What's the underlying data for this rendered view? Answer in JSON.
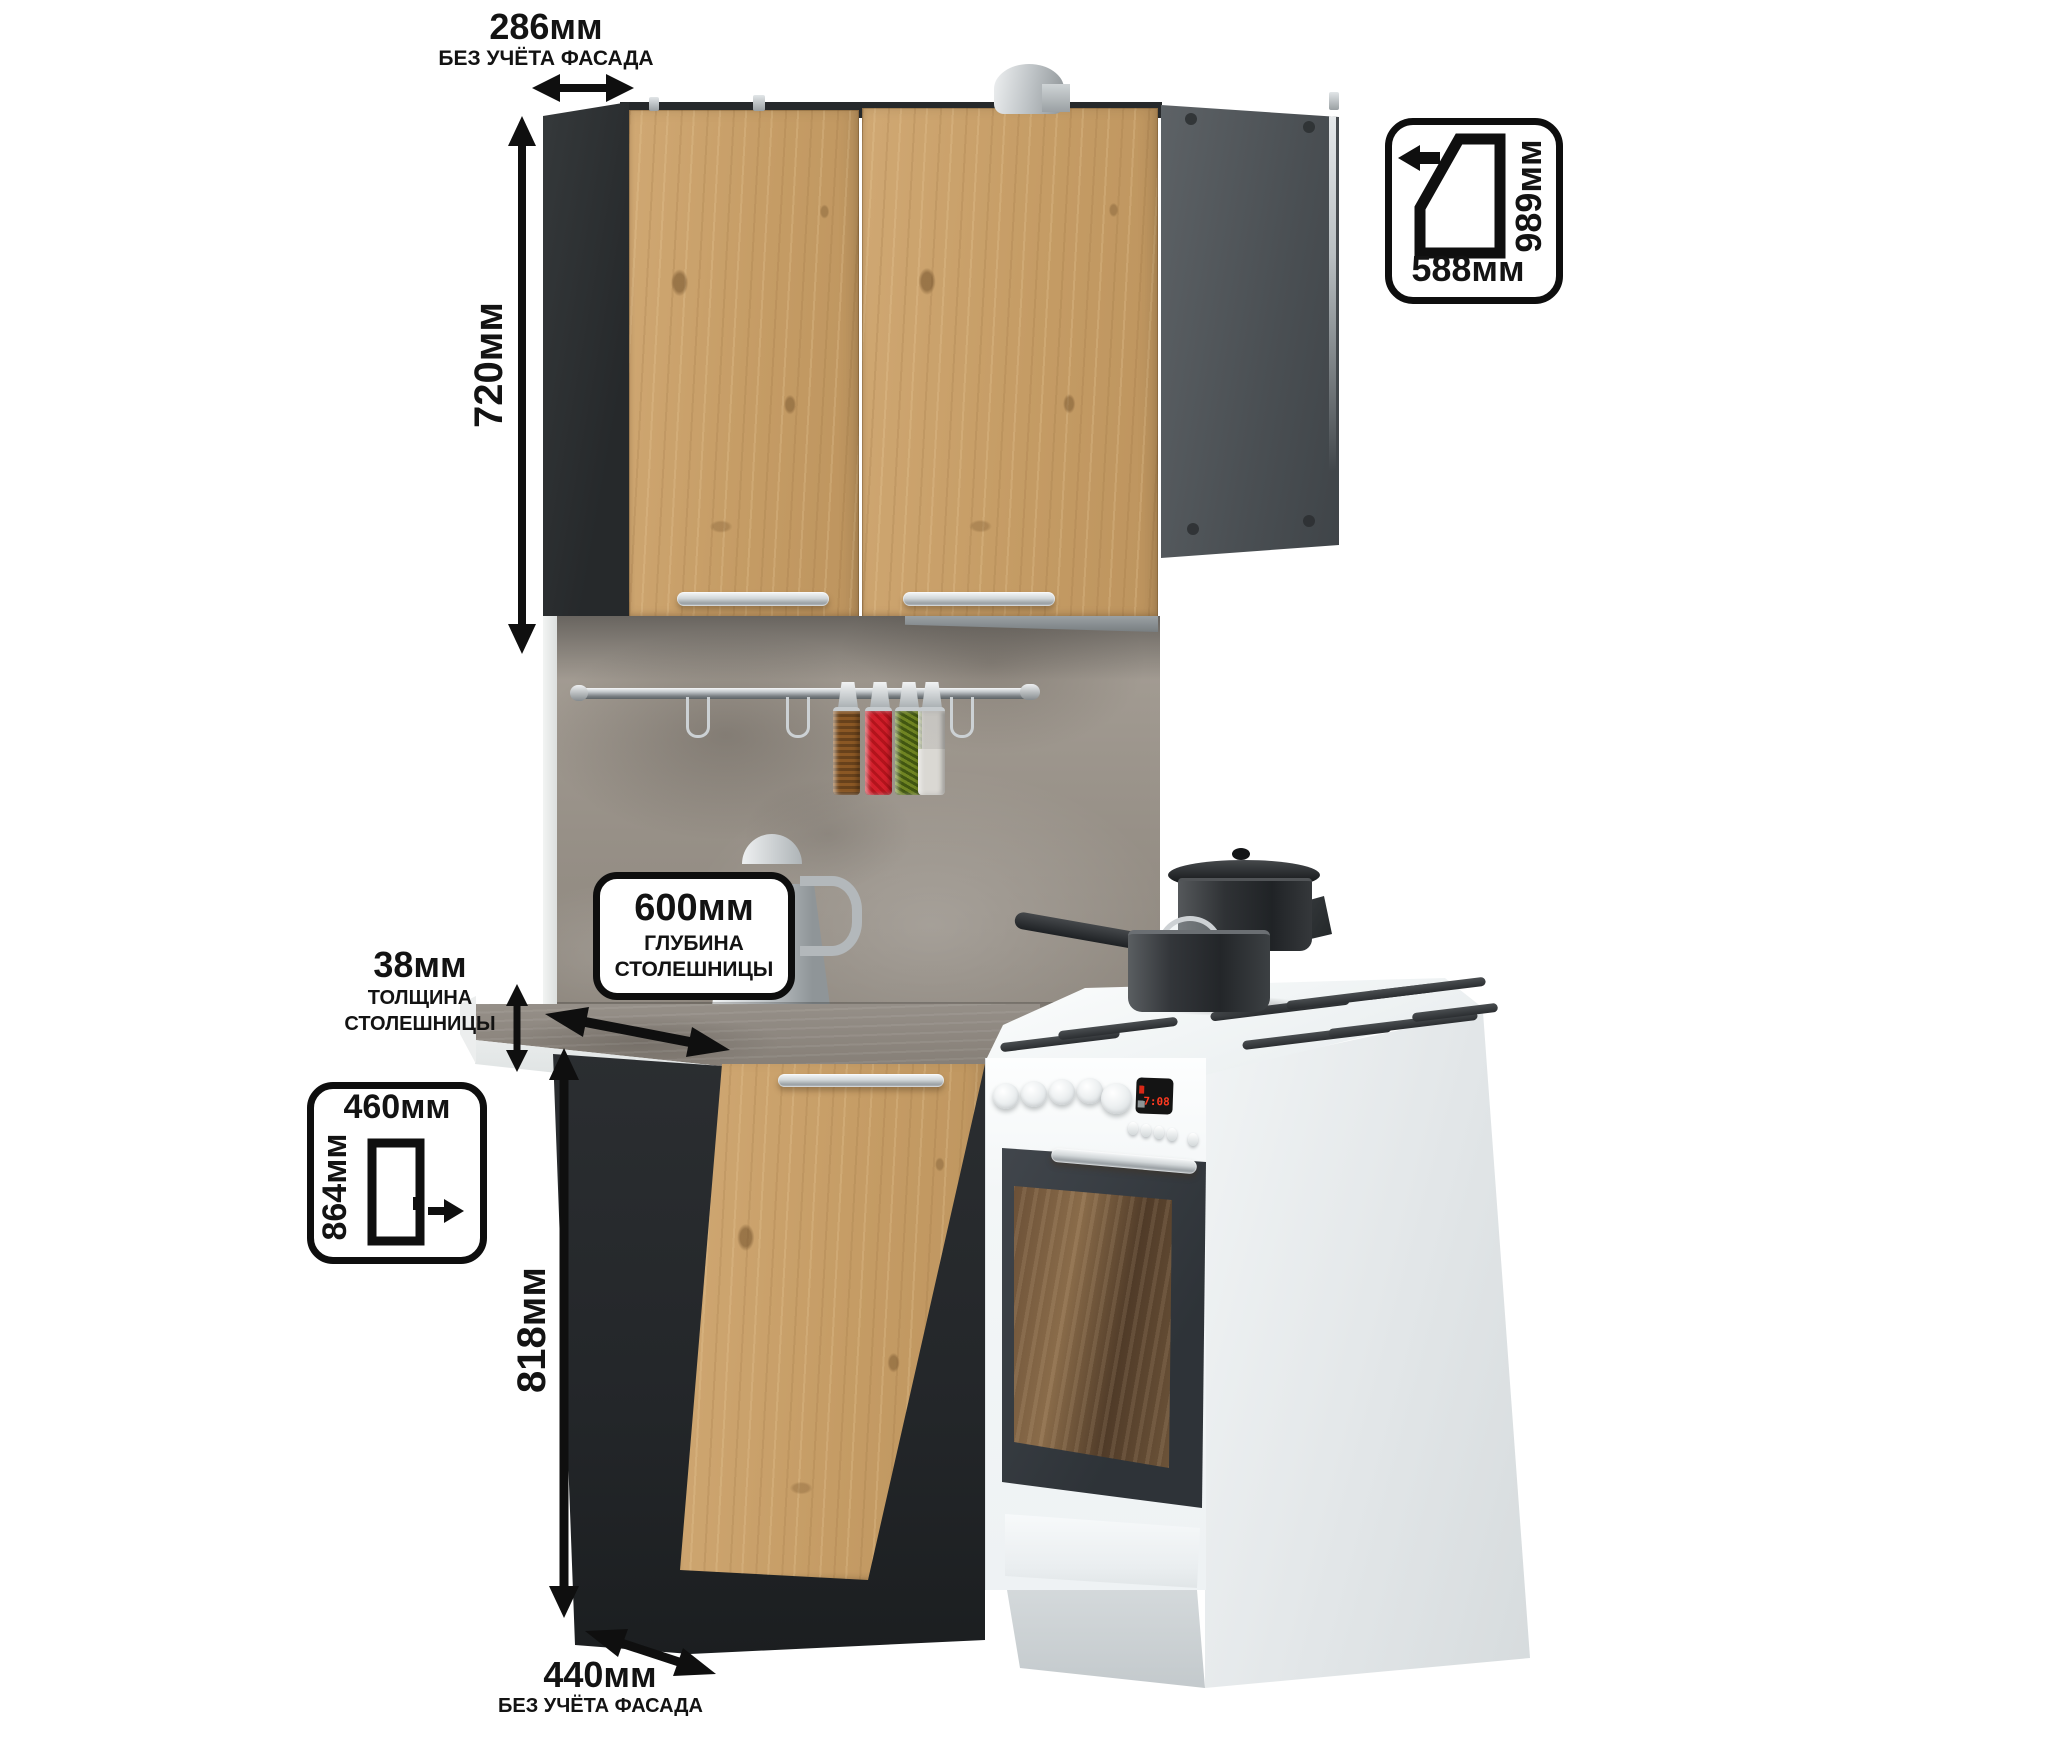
{
  "annotations": {
    "top_width": {
      "value": "286мм",
      "note": "БЕЗ УЧЁТА ФАСАДА"
    },
    "cabinet_height": {
      "value": "720мм"
    },
    "corner_plan": {
      "depth": "989мм",
      "width": "588мм"
    },
    "counter_depth": {
      "value": "600мм",
      "caption1": "ГЛУБИНА",
      "caption2": "СТОЛЕШНИЦЫ"
    },
    "counter_thickness": {
      "value": "38мм",
      "caption1": "ТОЛЩИНА",
      "caption2": "СТОЛЕШНИЦЫ"
    },
    "facade_door": {
      "width": "460мм",
      "height": "864мм"
    },
    "base_height": {
      "value": "818мм"
    },
    "bottom_width": {
      "value": "440мм",
      "note": "БЕЗ УЧЁТА ФАСАДА"
    }
  },
  "stove": {
    "display_time": "7:08"
  },
  "icons": {
    "width_arrow": "double-headed horizontal arrow",
    "height_arrow": "double-headed vertical arrow",
    "depth_arrow": "double-headed diagonal arrow",
    "thickness_arrow": "small double-headed vertical arrow",
    "corner_plan_icon": "corner-cabinet top-view outline",
    "open_direction_left_arrow": "left arrow",
    "door_icon": "door facade outline",
    "door_open_right_arrow": "right arrow"
  },
  "colors": {
    "oak": "#c79f66",
    "charcoal": "#2c2f31",
    "panel_gray": "#565b5f",
    "concrete_wall": "#9b948b",
    "countertop": "#8c857d",
    "stove_white": "#f4f6f7",
    "annotation_black": "#131313",
    "display_red": "#ff3a20",
    "handle_silver": "#c9cdd0"
  }
}
